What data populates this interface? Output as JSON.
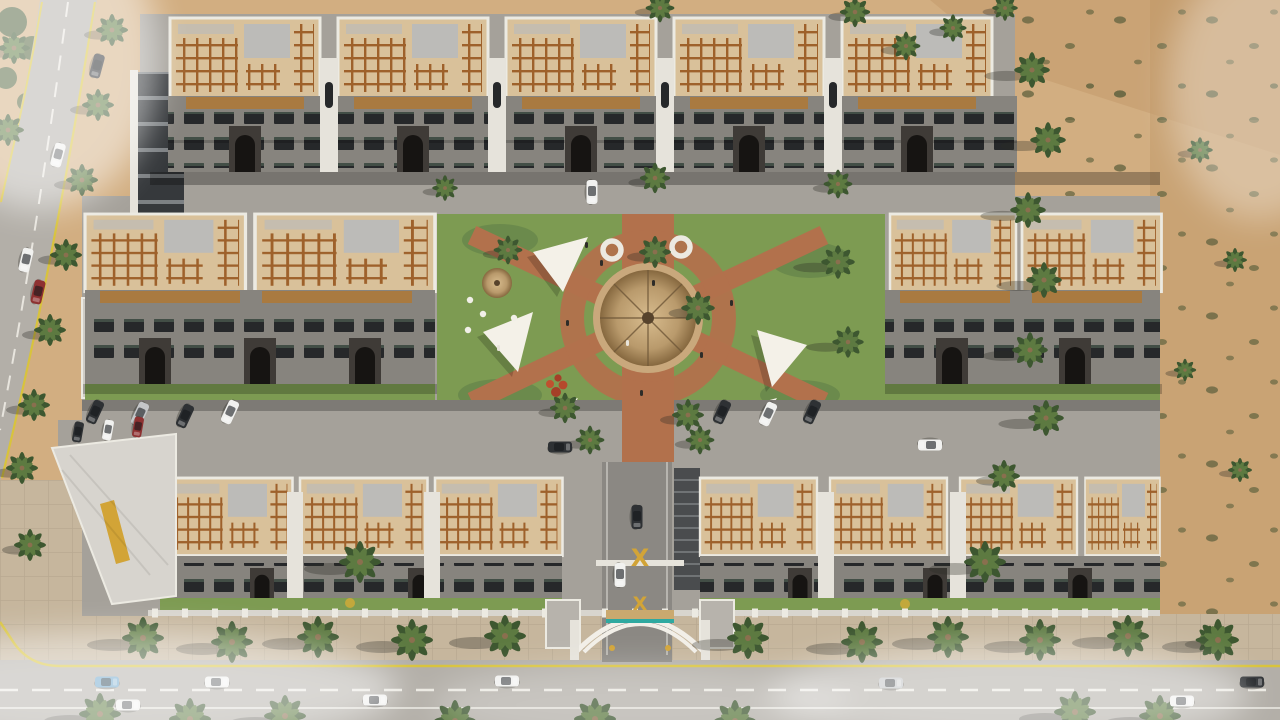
{
  "scene": {
    "title": "Aerial 3D architectural rendering of a walled residential compound in the desert, ringed by palm-lined streets with a landscaped central courtyard",
    "environment": "desert site, daytime, hazy atmosphere",
    "gate": {
      "logo_glyph": "X",
      "style": "gold emblem over arched white entrance gate with teal canopy"
    },
    "inventory": {
      "building_rows": 3,
      "top_row_buildings": 5,
      "middle_band_buildings": 4,
      "bottom_row_buildings": 7,
      "rooftops": "beige terraces with brown timber pergola grids and grey roof slabs",
      "facades": "grey stone with dark arched windows and timber balcony screens",
      "courtyard_features": [
        "central round thatched gazebo",
        "thatched kiosk with tables",
        "white shade sails",
        "lawns",
        "red-brick walkways",
        "round white planters",
        "red flowering shrub",
        "palm trees",
        "people walking"
      ],
      "shade_sails": 5,
      "round_planters": 2,
      "palm_trees_approx": 70,
      "cars_approx": 22,
      "roads": [
        "curved road on the left",
        "main boulevard along the bottom",
        "two internal streets",
        "gated entry drive"
      ]
    }
  },
  "colors": {
    "sand": "#d2ae81",
    "sandDark": "#c09767",
    "shrub": "#6d6a45",
    "road": "#b3afa8",
    "innerStreet": "#a5a19a",
    "drive": "#8b8883",
    "ramp": "#4a4c4e",
    "sidewalk": "#c6b69d",
    "yellowLine": "#d8c33c",
    "whiteLine": "#f1efe8",
    "lawn": "#7d9b52",
    "lawnDark": "#64834a",
    "pathBrick": "#b2714c",
    "thatch": "#c2a479",
    "sail": "#f4f1e8",
    "roofTan": "#d9c19a",
    "pergola": "#9e612b",
    "parapet": "#eceae2",
    "roofPanel": "#bcbbb8",
    "facade": "#87847e",
    "window": "#26282a",
    "wood": "#a97a40",
    "stone": "#3f3b37",
    "towerWhite": "#e6e3db",
    "shopDark": "#36393c",
    "wallLight": "#d8d5ce",
    "gold": "#d2a437",
    "teal": "#2fa9a0",
    "palm": "#5d7a41",
    "palmDark": "#3d5730",
    "trunk": "#8a6f4e",
    "shadow": "rgba(45,42,36,0.32)",
    "haze": "#ffffff",
    "carWhite": "#f1f1ef",
    "carSilver": "#c4c6c8",
    "carBlue": "#6fa7cc",
    "carRed": "#8e3131",
    "carDark": "#2e3134"
  }
}
